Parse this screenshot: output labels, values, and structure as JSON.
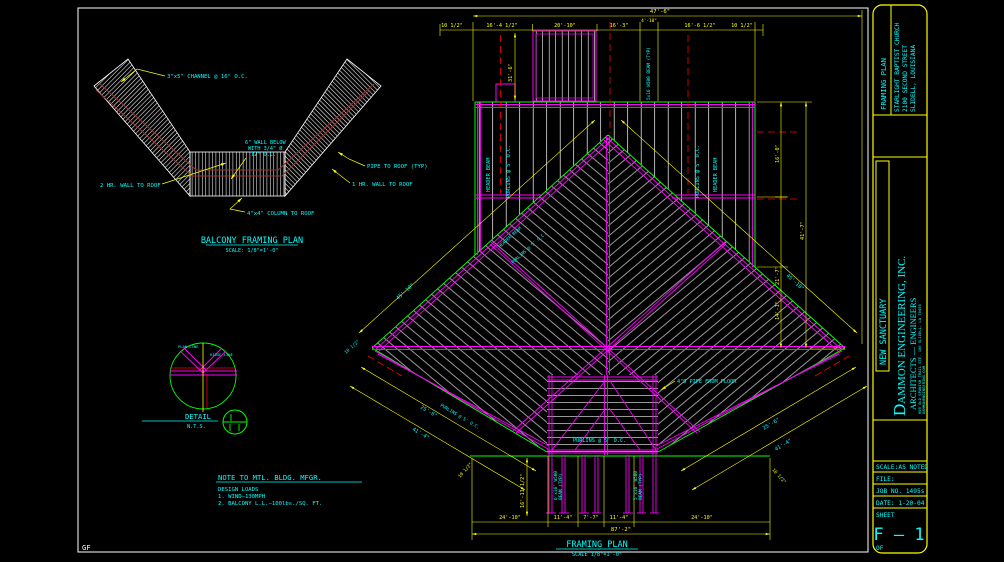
{
  "sheet": {
    "corner_label": "GF"
  },
  "balcony_plan": {
    "title": "BALCONY FRAMING PLAN",
    "scale": "SCALE: 1/8\"=1'-0\"",
    "labels": {
      "channel": "3\"x5\" CHANNEL @ 16\" O.C.",
      "wall_below_1": "6\" WALL BELOW",
      "wall_below_2": "WITH 3/4\" Ø",
      "wall_below_3": "12\" O.C.",
      "pipe": "PIPE TO ROOF (TYP)",
      "wall_2hr": "2 HR. WALL TO ROOF",
      "wall_1hr": "1 HR. WALL TO ROOF",
      "column": "4\"x4\" COLUMN TO ROOF"
    }
  },
  "detail": {
    "title": "DETAIL",
    "scale": "N.T.S.",
    "labels": {
      "plan_line": "PLAN LINE",
      "ridge": "RIDGE LINE"
    }
  },
  "notes": {
    "title": "NOTE TO MTL. BLDG. MFGR.",
    "lines": [
      "DESIGN LOADS",
      "1. WIND—130MPH",
      "2. BALCONY L.L.—100lbs./SQ. FT."
    ]
  },
  "framing_plan": {
    "title": "FRAMING PLAN",
    "scale": "SCALE 1/8\"=1'-0\"",
    "labels": {
      "header_beam": "HEADER BEAM",
      "purlins": "PURLINS @ 5' O.C.",
      "beam_typ": "5x16 W500 BEAM (TYP)",
      "beam_left_a": "6'x16' W500",
      "beam_left_b": "BEAM (TYP)",
      "beam_right_a": "5'x16' W500",
      "pipe_from_floor": "4\"Ø PIPE FROM FLOOR"
    },
    "dims": {
      "top_overall": "47'-6\"",
      "top": [
        "10 1/2\"",
        "16'-4 1/2\"",
        "20'-10\"",
        "16'-3\"",
        "4'-10\"",
        "16'-6 1/2\"",
        "10 1/2\""
      ],
      "bump_height": "31'-6\"",
      "right": [
        "16'-0\"",
        "21'-7\"",
        "14'-1\""
      ],
      "right_overall": "41'-7\"",
      "bottom": [
        "24'-10\"",
        "11'-4\"",
        "7'-7\"",
        "11'-4\"",
        "24'-10\""
      ],
      "bottom_overall": "87'-2\"",
      "left_vert": "16'-11 1/2\"",
      "diag_upper": "45'-10\"",
      "diag_inner": "25'-6\"",
      "diag_outer": "41'-4\"",
      "offset": "10 1/2\""
    }
  },
  "title_block": {
    "plan_type": "FRAMING PLAN",
    "project_line1": "STARLIGHT BAPTIST CHURCH",
    "project_line2": "2100 SECOND STREET",
    "project_line3": "SLIDELL, LOUISIANA",
    "project_name": "NEW SANCTUARY",
    "firm_initial": "D",
    "firm_rest": "AMMON ENGINEERING, INC.",
    "firm_sub": "ARCHITECTS — ENGINEERS",
    "firm_addr1": "600 OLD SPANISH TRAIL STE. 100 SLIDELL, LA 70458",
    "firm_addr2": "DAMMONENGINEERING.COM",
    "scale": "SCALE:AS NOTED",
    "file": "FILE:",
    "job": "JOB NO. 1495s",
    "date": "DATE: 1-20-04",
    "sheet_label": "SHEET",
    "sheet_no": "F — 1",
    "of": "OF"
  }
}
